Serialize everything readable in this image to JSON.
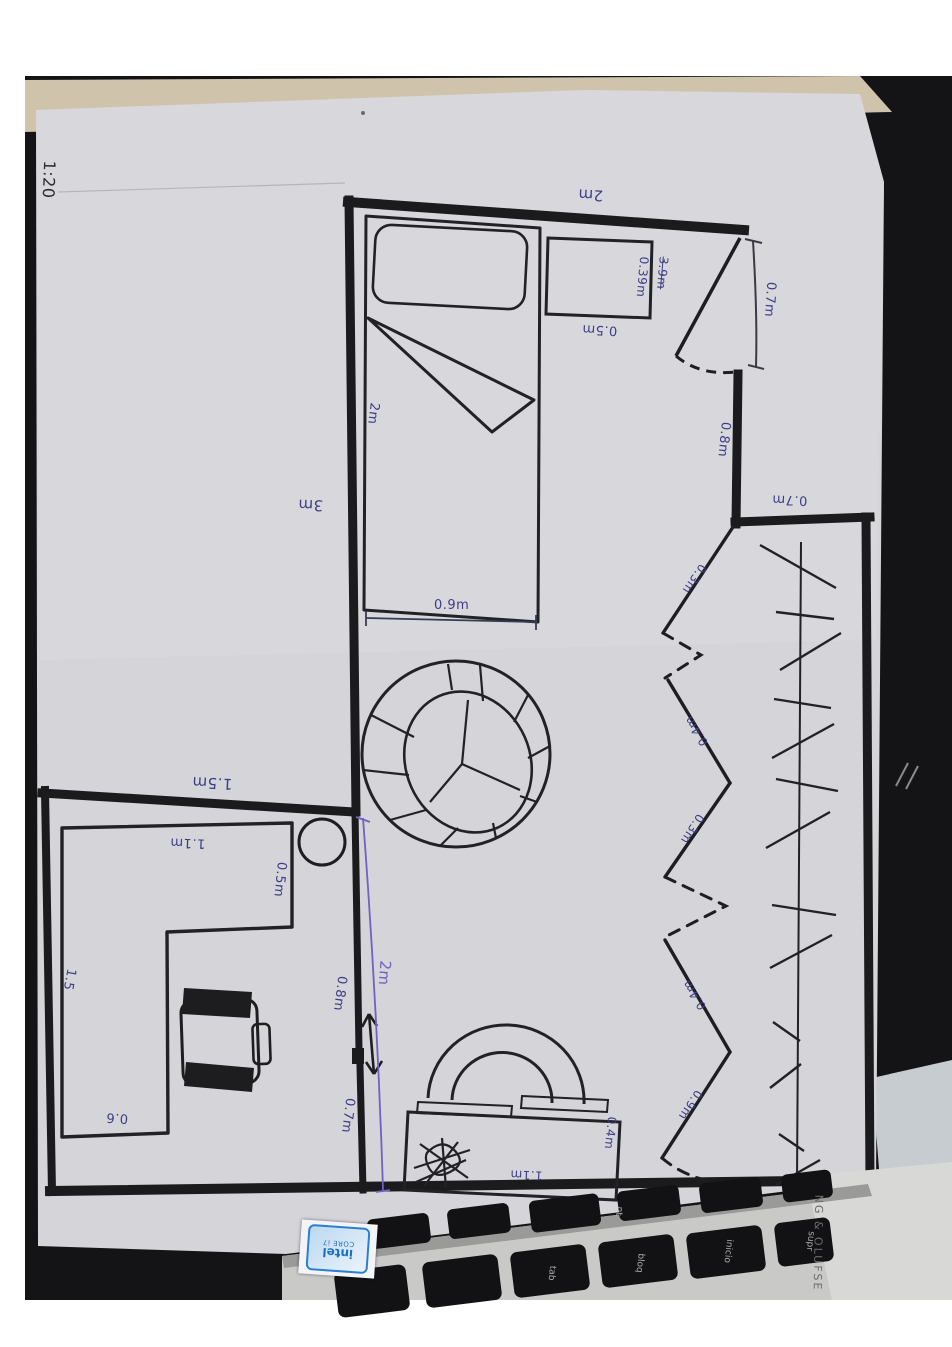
{
  "scale_label": "1:20",
  "walls": {
    "bedroom_top": "2m",
    "bedroom_left": "3m",
    "desk_room_top": "1.5m",
    "right_below_door": "0.8m",
    "middle_upper": "0.8m",
    "middle_lower": "0.7m",
    "middle_total": "2m"
  },
  "bed": {
    "length": "2m",
    "width": "0.9m"
  },
  "side_table": {
    "width": "0.5m",
    "depth": "0.39m",
    "crossed_out": "3.9m"
  },
  "door": {
    "width": "0.7m"
  },
  "closet": {
    "depth": "0.7m",
    "panels": [
      "0.3m",
      "0.4m",
      "0.3m",
      "0.4m",
      "0.9m"
    ]
  },
  "desk": {
    "top": "1.1m",
    "right": "0.5m",
    "left": "1.5",
    "bottom": "0.6"
  },
  "console": {
    "width": "1.1m",
    "depth": "0.4m"
  },
  "laptop": {
    "sticker_line1": "intel",
    "sticker_line2": "CORE i7",
    "speaker_text": "NG & OLUFSE",
    "key_labels": [
      "nt",
      "tab",
      "bloq",
      "inicio",
      "supr"
    ]
  }
}
